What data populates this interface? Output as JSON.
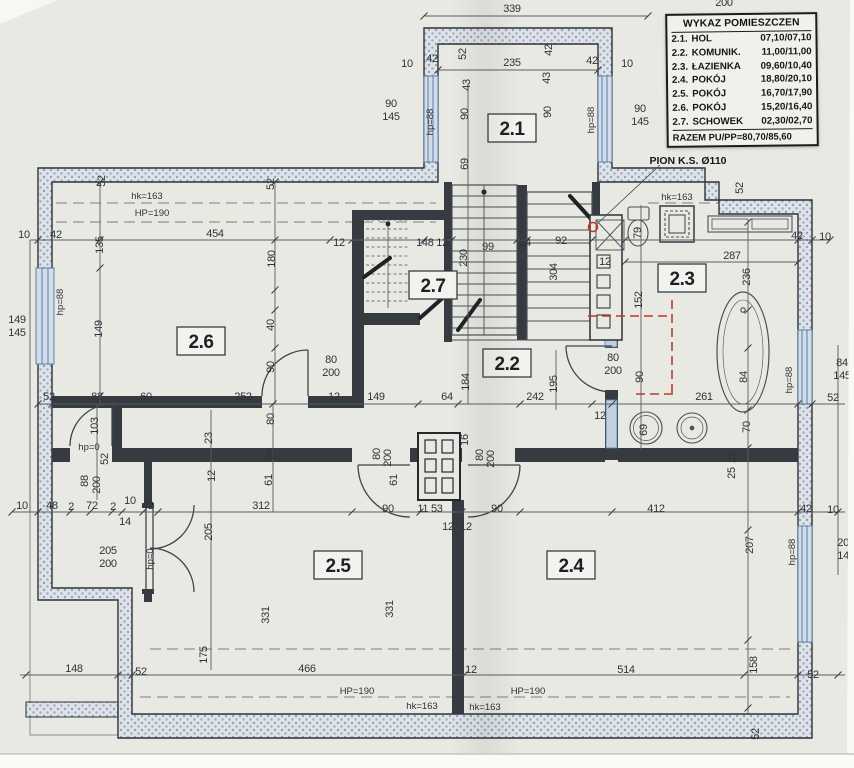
{
  "legend": {
    "title": "WYKAZ POMIESZCZEN",
    "rows": [
      {
        "no": "2.1.",
        "name": "HOL",
        "area": "07,10/07,10"
      },
      {
        "no": "2.2.",
        "name": "KOMUNIK.",
        "area": "11,00/11,00"
      },
      {
        "no": "2.3.",
        "name": "ŁAZIENKA",
        "area": "09,60/10,40"
      },
      {
        "no": "2.4.",
        "name": "POKÓJ",
        "area": "18,80/20,10"
      },
      {
        "no": "2.5.",
        "name": "POKÓJ",
        "area": "16,70/17,90"
      },
      {
        "no": "2.6.",
        "name": "POKÓJ",
        "area": "15,20/16,40"
      },
      {
        "no": "2.7.",
        "name": "SCHOWEK",
        "area": "02,30/02,70"
      }
    ],
    "total": "RAZEM PU/PP=80,70/85,60"
  },
  "rooms": {
    "r21": "2.1",
    "r22": "2.2",
    "r23": "2.3",
    "r24": "2.4",
    "r25": "2.5",
    "r26": "2.6",
    "r27": "2.7"
  },
  "annotations": {
    "pion": "PION K.S. Ø110"
  },
  "dims": {
    "n339": "339",
    "n200top": "200",
    "n10a": "10",
    "n42a": "42",
    "n52a": "52",
    "n43a": "43",
    "n235": "235",
    "n43b": "43",
    "n42b": "42",
    "n42c": "42",
    "n10b": "10",
    "n90a": "90",
    "n145a": "145",
    "n90b": "90",
    "n145b": "145",
    "hp88a": "hp=88",
    "hp88b": "hp=88",
    "n90c": "90",
    "n90d": "90",
    "n69a": "69",
    "n52b": "52",
    "n52c": "52",
    "hk163a": "hk=163",
    "HP190a": "HP=190",
    "n10c": "10",
    "n42d": "42",
    "n135": "135",
    "n454": "454",
    "n180": "180",
    "n12a": "12",
    "n148_12": "148 12",
    "n230": "230",
    "n99": "99",
    "n24": "24",
    "n92": "92",
    "n304": "304",
    "n12b": "12",
    "n287": "287",
    "n79": "79",
    "n52d": "52",
    "n42e": "42",
    "n10d": "10",
    "n236": "236",
    "hk163b": "hk=163",
    "n152": "152",
    "n90e": "90",
    "n84a": "84",
    "hp88c": "hp=88",
    "n84b": "84",
    "n145c": "145",
    "n52e": "52",
    "n184": "184",
    "n195": "195",
    "n80a": "80",
    "n200a": "200",
    "hp88d": "hp=88",
    "n149a": "149",
    "n145d": "145",
    "n149b": "149",
    "n40": "40",
    "n90f": "90",
    "n80b": "80",
    "n200b": "200",
    "n52f": "52",
    "n88a": "88",
    "n60": "60",
    "n252": "252",
    "n12c": "12",
    "n149c": "149",
    "n64": "64",
    "n242": "242",
    "n12d": "12",
    "n261": "261",
    "n103": "103",
    "hp0a": "hp=0",
    "n52g": "52",
    "n88b": "88",
    "n200c": "200",
    "n10e": "10",
    "n48": "48",
    "n2a": "2",
    "n72": "72",
    "n2b": "2",
    "n10f": "10",
    "n42f": "42",
    "n14": "14",
    "n205a": "205",
    "n200d": "200",
    "hp0b": "hp=0",
    "n23": "23",
    "n12e": "12",
    "n61a": "61",
    "n80c": "80",
    "n25a": "25",
    "n312": "312",
    "n205b": "205",
    "n61b": "61",
    "n80d": "80",
    "n200e": "200",
    "n16": "16",
    "n80e": "80",
    "n200f": "200",
    "n90g": "90",
    "n1153": "11 53",
    "n12g": "12",
    "n12h": "12",
    "n90h": "90",
    "n412": "412",
    "n42g": "42",
    "n10g": "10",
    "n331a": "331",
    "n331b": "331",
    "n175": "175",
    "n207a": "207",
    "hp88e": "hp=88",
    "n207b": "207",
    "n145e": "145",
    "n158": "158",
    "n52h": "52",
    "n27": "27",
    "n25b": "25",
    "n70": "70",
    "n69b": "69",
    "n52k": "52",
    "n148": "148",
    "n52j": "52",
    "n466": "466",
    "n12i": "12",
    "n514": "514",
    "HP190b": "HP=190",
    "hk163c": "hk=163",
    "hk163d": "hk=163",
    "HP190c": "HP=190"
  }
}
